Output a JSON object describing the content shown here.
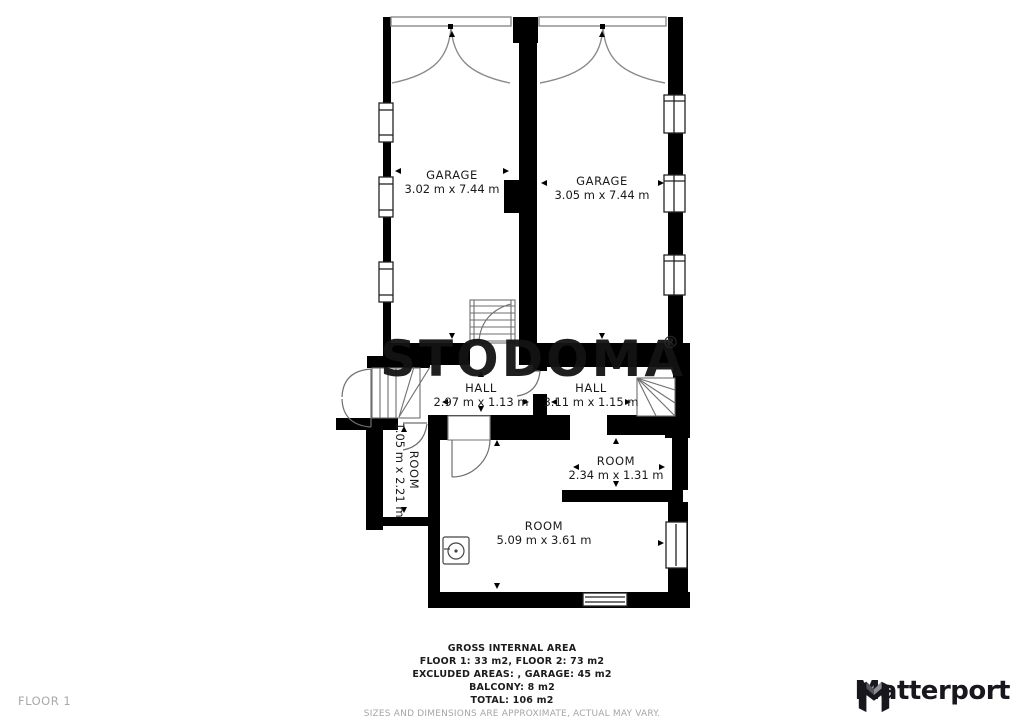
{
  "floorplan": {
    "watermark": "STODOMA",
    "watermark_reg": "®",
    "rooms": [
      {
        "name": "GARAGE",
        "dims": "3.02 m x 7.44 m"
      },
      {
        "name": "GARAGE",
        "dims": "3.05 m x 7.44 m"
      },
      {
        "name": "HALL",
        "dims": "2.97 m x 1.13 m"
      },
      {
        "name": "HALL",
        "dims": "3.11 m x 1.15 m"
      },
      {
        "name": "ROOM",
        "dims": "1.05 m x 2.21 m"
      },
      {
        "name": "ROOM",
        "dims": "2.34 m x 1.31 m"
      },
      {
        "name": "ROOM",
        "dims": "5.09 m x 3.61 m"
      }
    ]
  },
  "footer": {
    "floor_label": "FLOOR 1",
    "summary": {
      "title": "GROSS INTERNAL AREA",
      "line1": "FLOOR 1: 33 m2, FLOOR 2: 73 m2",
      "line2": "EXCLUDED AREAS: , GARAGE: 45 m2",
      "line3": "BALCONY: 8 m2",
      "line4": "TOTAL: 106 m2",
      "disclaimer": "SIZES AND DIMENSIONS ARE APPROXIMATE, ACTUAL MAY VARY."
    },
    "brand": "Matterport"
  },
  "colors": {
    "wall": "#000000",
    "text": "#1a1a1a",
    "muted": "#a6a6a6",
    "brand": "#17171d"
  }
}
